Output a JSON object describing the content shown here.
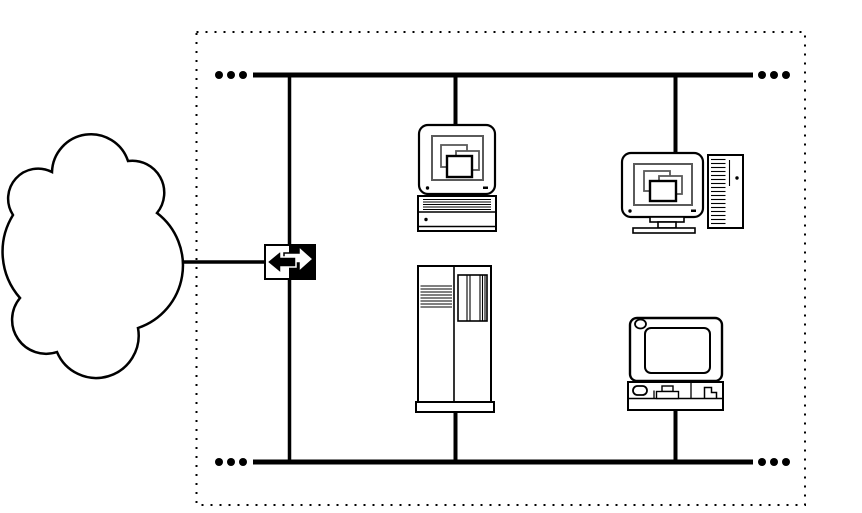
{
  "diagram": {
    "type": "network-topology",
    "colors": {
      "background": "#ffffff",
      "line": "#000000",
      "fill": "#ffffff",
      "window_outline": "#5a5a5a"
    },
    "boundary": {
      "id": "network-boundary",
      "border_style": "dotted"
    },
    "buses": [
      {
        "id": "top-bus",
        "continues": "ellipsis-both-ends"
      },
      {
        "id": "bottom-bus",
        "continues": "ellipsis-both-ends"
      }
    ],
    "links": [
      {
        "id": "wan-link",
        "from": "internet-cloud",
        "to": "router"
      },
      {
        "id": "backbone-link",
        "from": "top-bus",
        "to": "bottom-bus",
        "through": "router"
      },
      {
        "id": "workstation-top-link",
        "from": "workstation-top",
        "to": "top-bus"
      },
      {
        "id": "workstation-right-link",
        "from": "workstation-right",
        "to": "top-bus"
      },
      {
        "id": "server-link",
        "from": "server",
        "to": "bottom-bus"
      },
      {
        "id": "laptop-link",
        "from": "laptop",
        "to": "bottom-bus"
      }
    ],
    "nodes": [
      {
        "id": "internet-cloud",
        "icon": "cloud-icon"
      },
      {
        "id": "router",
        "icon": "bidirectional-arrow-icon"
      },
      {
        "id": "workstation-top",
        "icon": "desktop-computer-icon"
      },
      {
        "id": "workstation-right",
        "icon": "desktop-with-tower-icon"
      },
      {
        "id": "server",
        "icon": "server-tower-icon"
      },
      {
        "id": "laptop",
        "icon": "laptop-icon"
      }
    ]
  }
}
